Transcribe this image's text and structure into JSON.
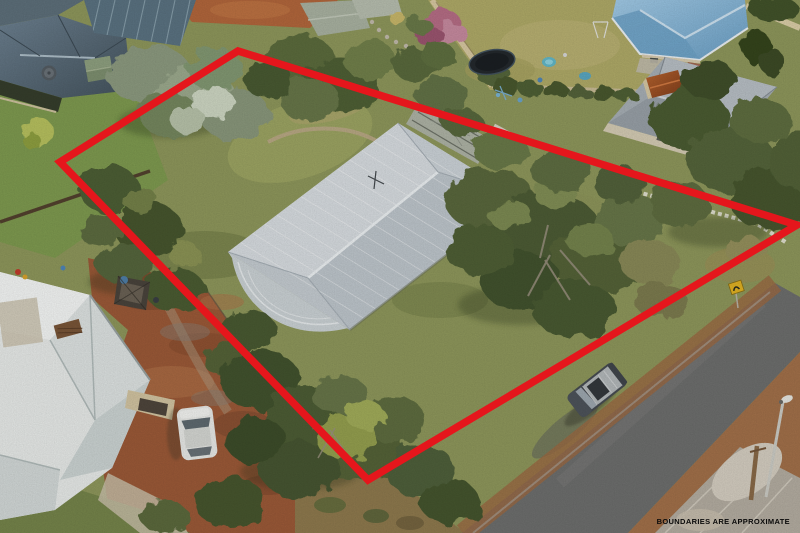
{
  "photo": {
    "disclaimer": "BOUNDARIES ARE APPROXIMATE"
  },
  "boundary": {
    "points": "238,51 797,225 368,480 60,162",
    "color": "#e5161c",
    "stroke_width": "7.5"
  },
  "colors": {
    "disclaimer_text": "#0b0b0b",
    "main_roof_silver": "#cdd5da",
    "left_house_roof_white": "#e9ecea",
    "neighbor_roof_blue": "#85b7da",
    "neighbor_roof_slate": "#54646f",
    "shed_roof_grey": "#a8b0b6",
    "road_asphalt": "#6e6f6e",
    "driveway_gravel": "#9c5a38",
    "lawn_olive": "#939b5e"
  }
}
